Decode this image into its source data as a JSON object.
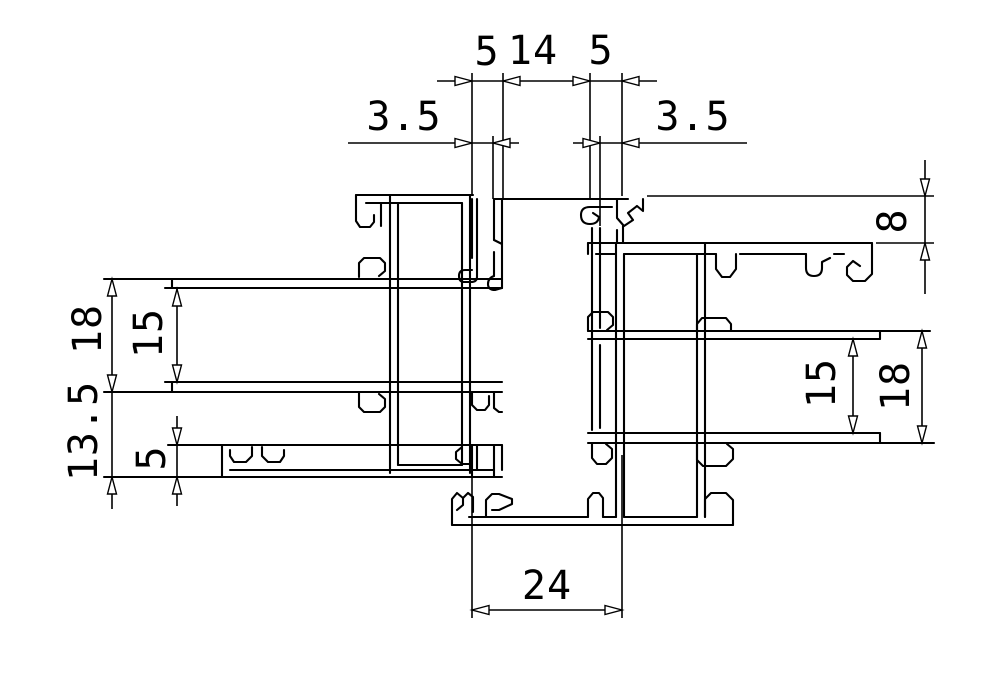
{
  "drawing": {
    "type": "cad-cross-section",
    "description": "Interlocking aluminium window sash meeting-stile profiles, dimensioned cross section",
    "background_color": "#ffffff",
    "line_color": "#000000",
    "dimensions": {
      "top": {
        "left": "5",
        "middle": "14",
        "right": "5"
      },
      "upper": {
        "left": "3.5",
        "right": "3.5"
      },
      "right_top": {
        "value": "8"
      },
      "left_col": {
        "outer": "18",
        "inner": "15",
        "lower": "13.5",
        "channel": "5"
      },
      "right_col": {
        "inner": "15",
        "outer": "18"
      },
      "bottom": {
        "width": "24"
      }
    }
  }
}
